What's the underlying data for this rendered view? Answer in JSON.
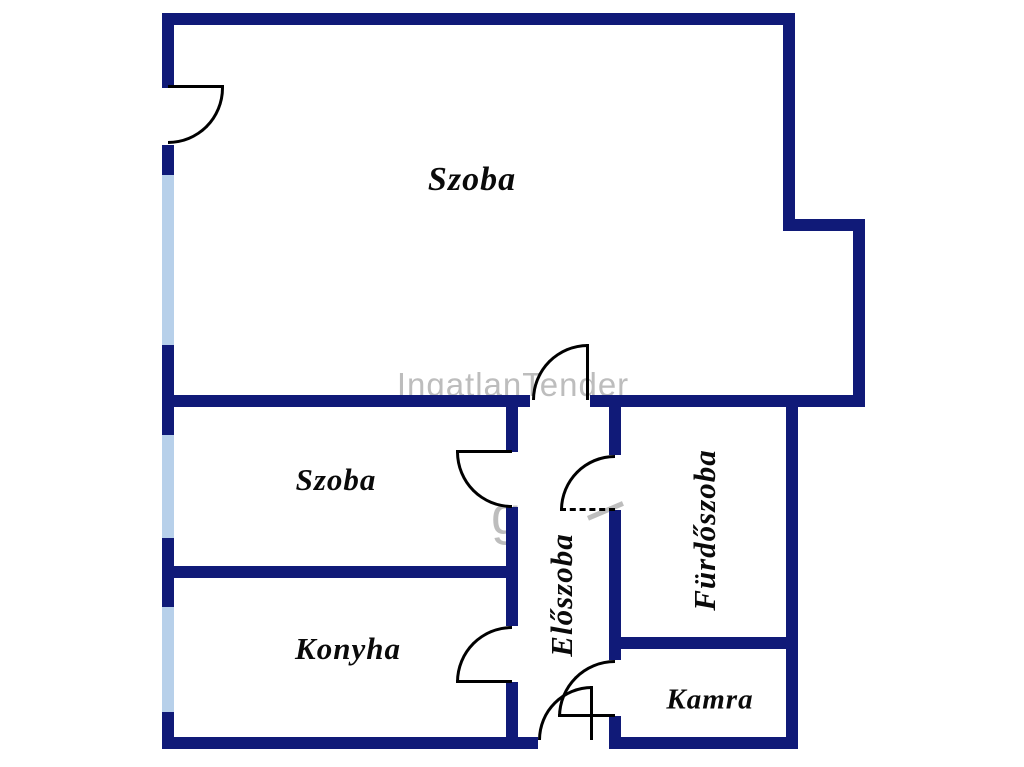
{
  "colors": {
    "background": "#ffffff",
    "wall": "#101a78",
    "window": "#b7d0ea",
    "door": "#000000",
    "label": "#0a0a0a",
    "watermark": "#bdbdbd"
  },
  "watermark": {
    "text": "IngatlanTender",
    "fragment_letter": "g"
  },
  "rooms": {
    "szoba_main": {
      "label": "Szoba"
    },
    "szoba_small": {
      "label": "Szoba"
    },
    "konyha": {
      "label": "Konyha"
    },
    "eloszoba": {
      "label": "Előszoba"
    },
    "furdoszoba": {
      "label": "Fürdőszoba"
    },
    "kamra": {
      "label": "Kamra"
    }
  }
}
